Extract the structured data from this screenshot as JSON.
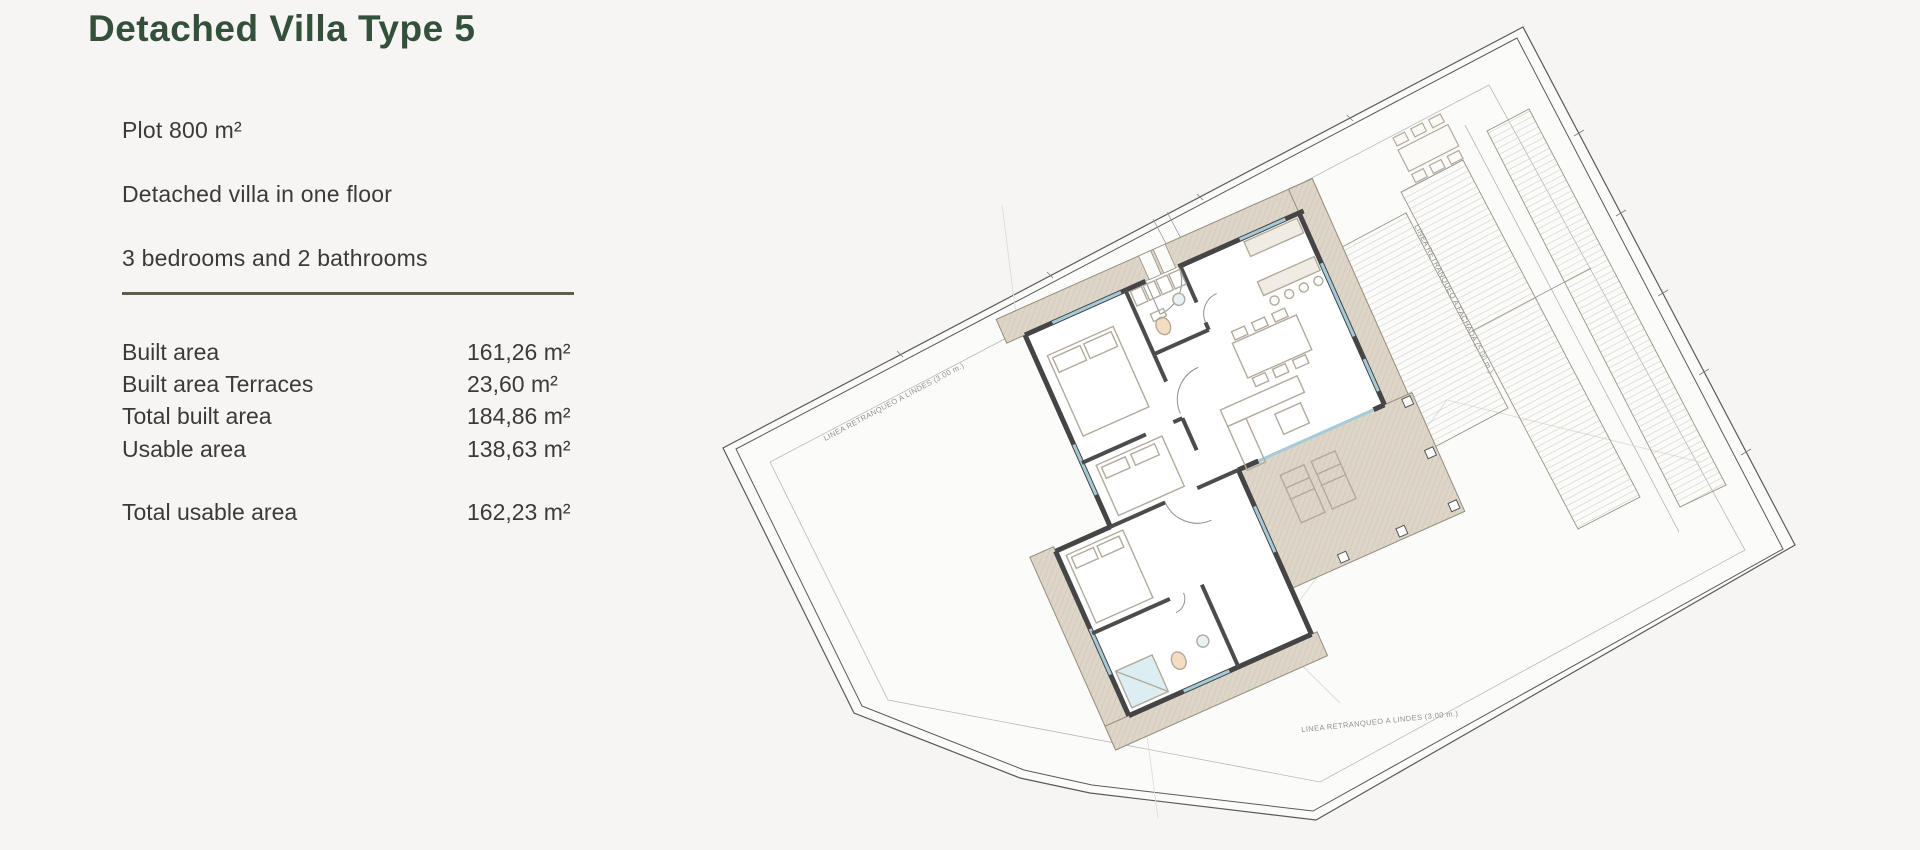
{
  "page": {
    "background": "#f6f5f3"
  },
  "info_panel": {
    "title": "Detached Villa Type 5",
    "features": [
      "Plot 800 m²",
      "Detached villa in one floor",
      "3 bedrooms and 2 bathrooms"
    ],
    "areas": [
      {
        "label": "Built area",
        "value": "161,26 m²"
      },
      {
        "label": "Built area Terraces",
        "value": "23,60 m²"
      },
      {
        "label": "Total built area",
        "value": "184,86 m²"
      },
      {
        "label": "Usable area",
        "value": "138,63 m²"
      }
    ],
    "total_row": {
      "label": "Total usable area",
      "value": "162,23 m²"
    },
    "colors": {
      "title": "#33503a",
      "text": "#3a3a38",
      "divider": "#5f5e49"
    }
  },
  "plan": {
    "labels": {
      "setback_boundary_top": "LINEA RETRANQUEO A LINDES (3.00 m.)",
      "setback_boundary_bottom": "LINEA RETRANQUEO A LINDES (3.00 m.)",
      "setback_facade": "LINEA RETRANQUEO A FACHADA (5.00 m.)"
    },
    "colors": {
      "boundary": "#5a5a58",
      "setback_line": "#b5b5b5",
      "wall": "#454545",
      "terrace_fill": "#ddd6c8",
      "terrace_edge": "#9a9181",
      "hatch_stripe": "#cfc8bc",
      "window": "#a5cbd8",
      "furniture": "#b3aa9c"
    }
  }
}
